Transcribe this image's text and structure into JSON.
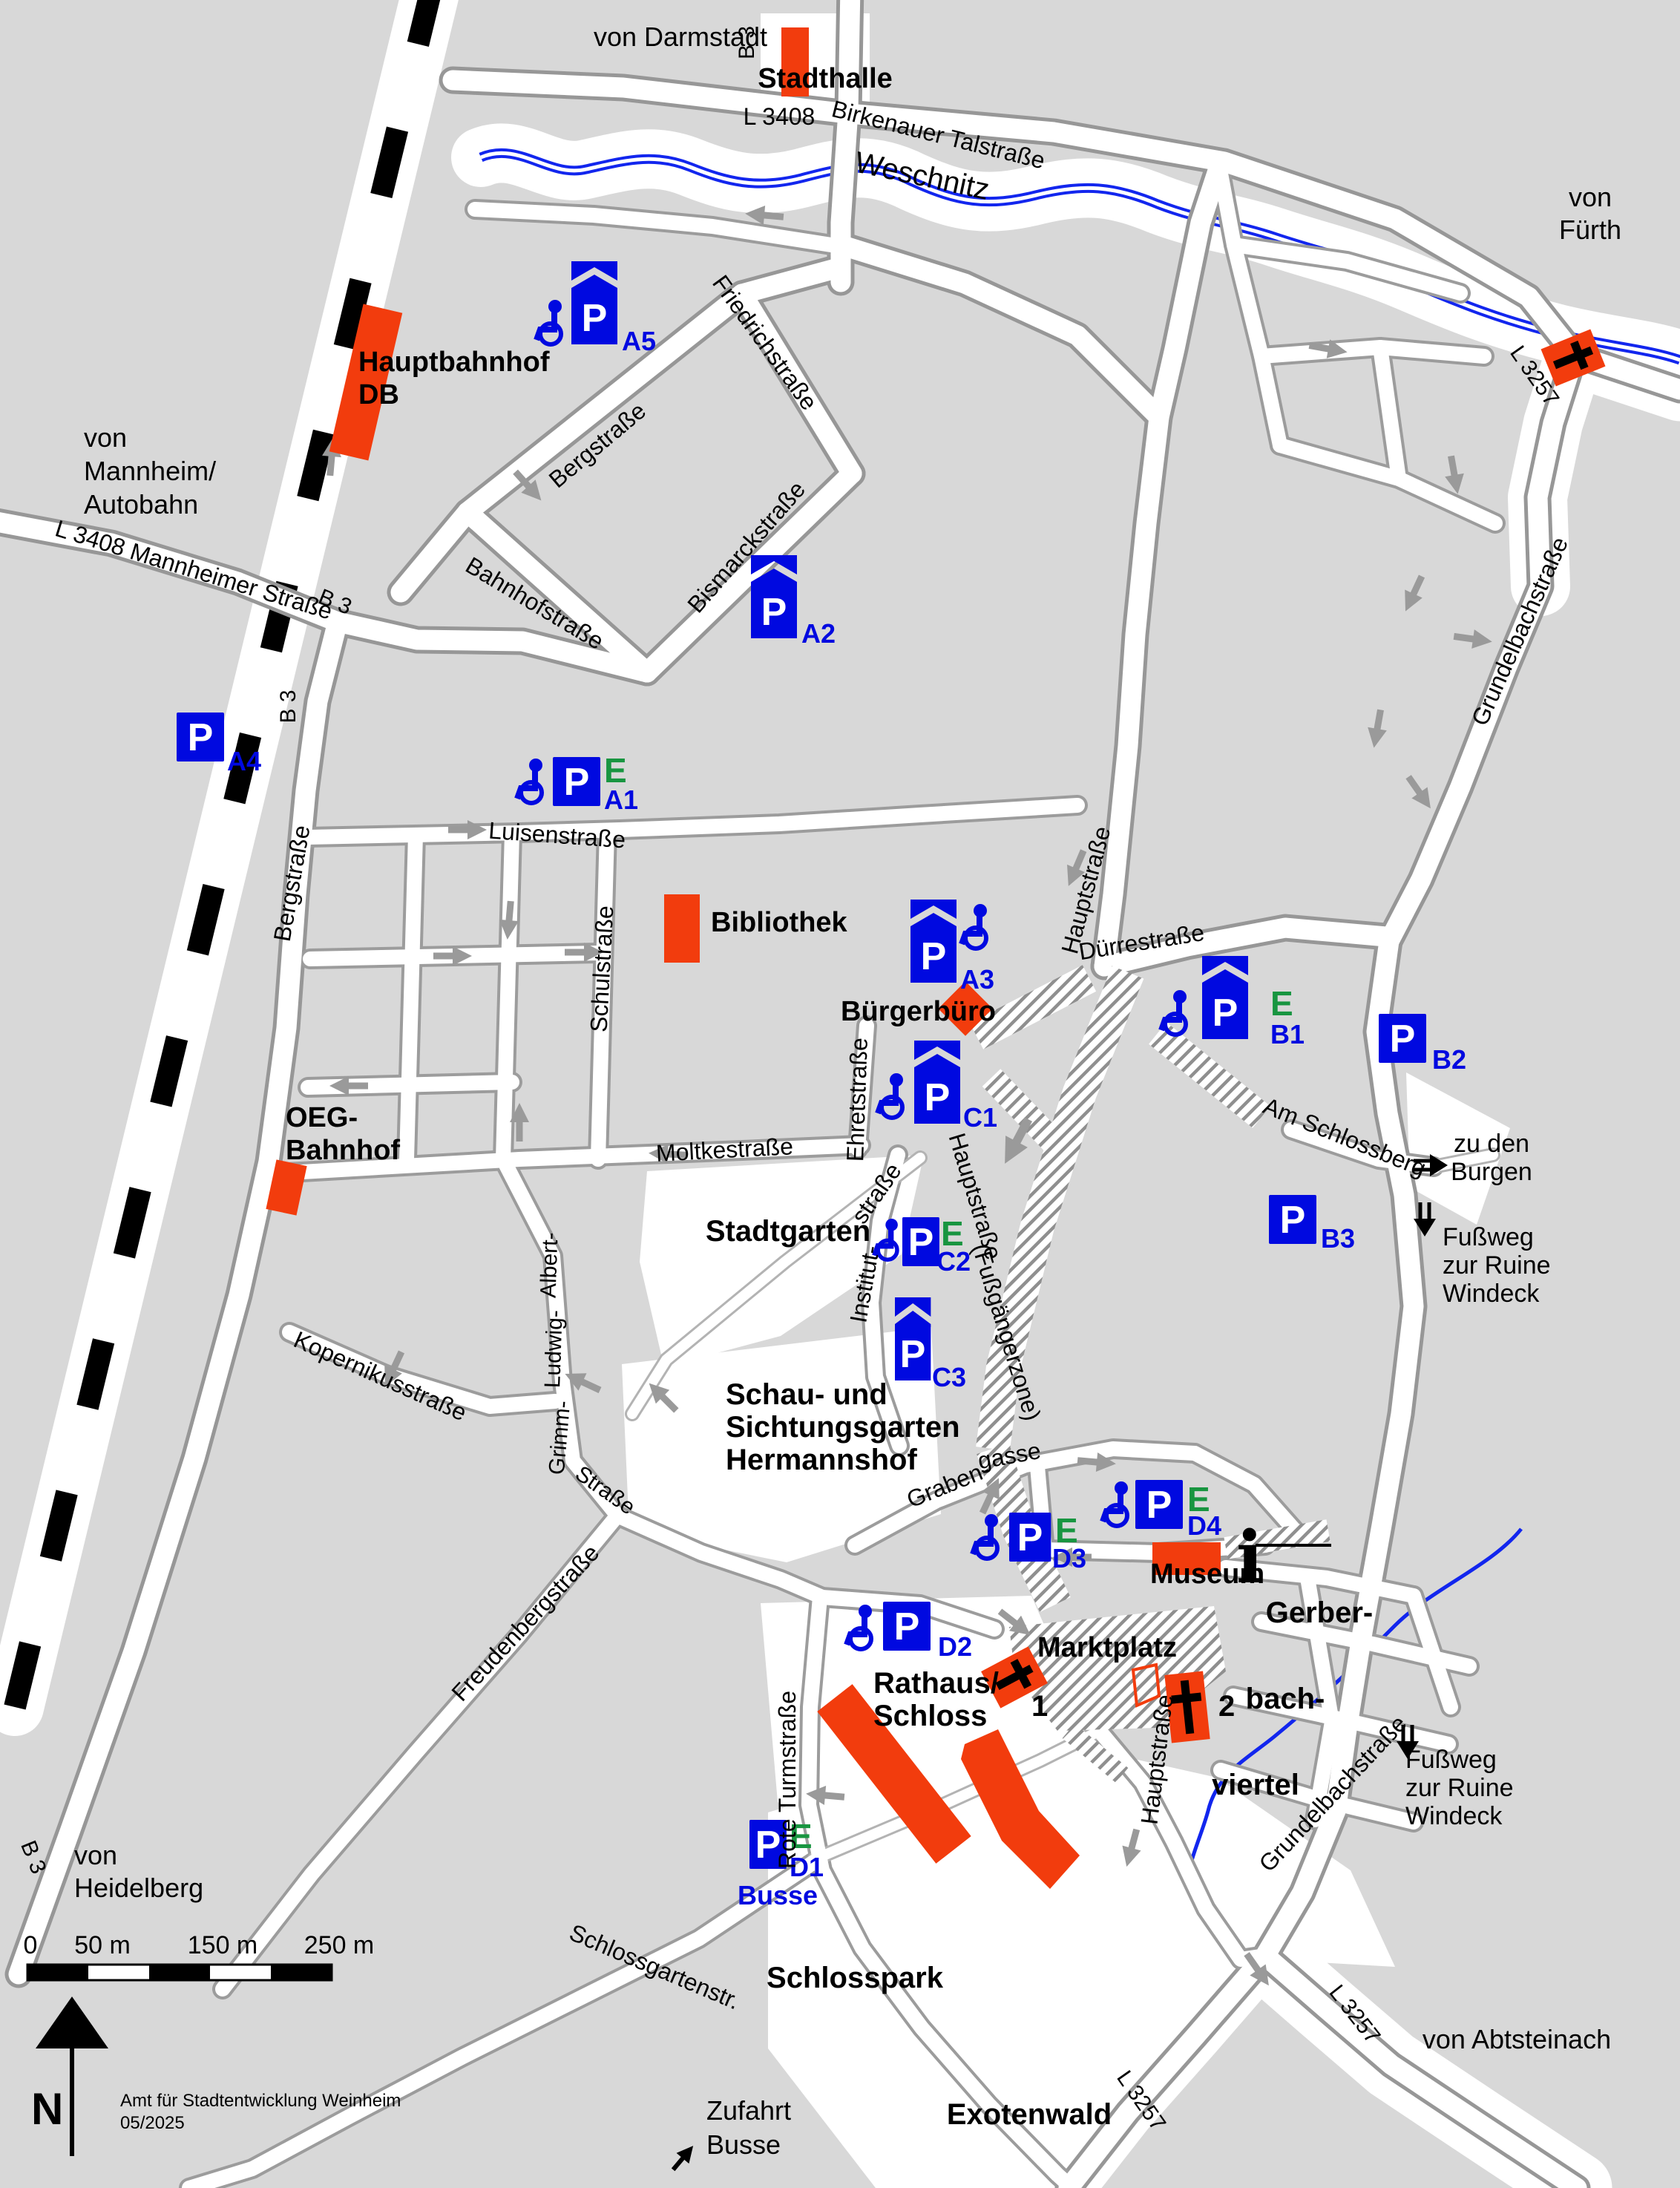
{
  "labels": {
    "von_darmstadt": "von Darmstadt",
    "b3_top": "B 3",
    "stadthalle": "Stadthalle",
    "l3408": "L 3408",
    "birkenauer_talstrasse": "Birkenauer Talstraße",
    "weschnitz": "Weschnitz",
    "von_fuerth_1": "von",
    "von_fuerth_2": "Fürth",
    "l3257_ne": "L 3257",
    "hauptbahnhof_1": "Hauptbahnhof",
    "hauptbahnhof_2": "DB",
    "bergstrasse_ne": "Bergstraße",
    "friedrichstrasse": "Friedrichstraße",
    "bismarckstrasse": "Bismarckstraße",
    "bahnhofstrasse": "Bahnhofstraße",
    "von_mannheim_1": "von",
    "von_mannheim_2": "Mannheim/",
    "von_mannheim_3": "Autobahn",
    "l3408_mannheimer": "L 3408 Mannheimer Straße",
    "b3_junction": "B 3",
    "b3_junction_s": "B 3",
    "luisenstrasse": "Luisenstraße",
    "bibliothek": "Bibliothek",
    "bergstrasse_w": "Bergstraße",
    "schulstrasse": "Schulstraße",
    "hauptstrasse_n": "Hauptstraße",
    "duerrestrasse": "Dürrestraße",
    "grundelbachstrasse_n": "Grundelbachstraße",
    "buergerbuero": "Bürgerbüro",
    "ehretstrasse": "Ehretstraße",
    "moltkestrasse": "Moltkestraße",
    "am_schlossberg": "Am Schlossberg",
    "zu_den_burgen_1": "zu den",
    "zu_den_burgen_2": "Burgen",
    "fussweg_ne_1": "Fußweg",
    "fussweg_ne_2": "zur Ruine",
    "fussweg_ne_3": "Windeck",
    "stadtgarten": "Stadtgarten",
    "institutstrasse_1": "straße",
    "institutstrasse_2": "Institut-",
    "hauptstrasse_fgz_1": "Hauptstraße",
    "hauptstrasse_fgz_2": "(Fußgängerzone)",
    "hermannshof_1": "Schau- und",
    "hermannshof_2": "Sichtungsgarten",
    "hermannshof_3": "Hermannshof",
    "oeg_1": "OEG-",
    "oeg_2": "Bahnhof",
    "kopernikusstrasse": "Kopernikusstraße",
    "albert": "Albert-",
    "ludwig": "Ludwig-",
    "grimm": "Grimm-",
    "grimm_strasse": "Straße",
    "graben": "Graben-",
    "gasse": "gasse",
    "museum": "Museum",
    "gerber": "Gerber-",
    "bach": "bach-",
    "viertel": "viertel",
    "marktplatz": "Marktplatz",
    "rathaus_1": "Rathaus/",
    "rathaus_2": "Schloss",
    "hauptstrasse_s": "Hauptstraße",
    "rote_turmstrasse": "Rote Turmstraße",
    "freudenbergstrasse": "Freudenbergstraße",
    "schlossgartenstr": "Schlossgartenstr.",
    "schlosspark": "Schlosspark",
    "zufahrt_1": "Zufahrt",
    "zufahrt_2": "Busse",
    "exotenwald": "Exotenwald",
    "l3257_se": "L 3257",
    "l3257_s": "L 3257",
    "von_abtsteinach": "von Abtsteinach",
    "von_heidelberg_1": "von",
    "von_heidelberg_2": "Heidelberg",
    "b3_sw": "B 3",
    "grundelbachstrasse_s": "Grundelbachstraße",
    "fussweg_se_1": "Fußweg",
    "fussweg_se_2": "zur Ruine",
    "fussweg_se_3": "Windeck"
  },
  "parking": {
    "p_letter": "P",
    "e_letter": "E",
    "lots": [
      {
        "id": "A1",
        "wheelchair": true,
        "covered": false,
        "charging": true
      },
      {
        "id": "A2",
        "wheelchair": false,
        "covered": true,
        "charging": false
      },
      {
        "id": "A3",
        "wheelchair": true,
        "covered": true,
        "charging": false
      },
      {
        "id": "A4",
        "wheelchair": false,
        "covered": false,
        "charging": false
      },
      {
        "id": "A5",
        "wheelchair": true,
        "covered": true,
        "charging": false
      },
      {
        "id": "B1",
        "wheelchair": true,
        "covered": true,
        "charging": true
      },
      {
        "id": "B2",
        "wheelchair": false,
        "covered": false,
        "charging": false
      },
      {
        "id": "B3",
        "wheelchair": false,
        "covered": false,
        "charging": false
      },
      {
        "id": "C1",
        "wheelchair": true,
        "covered": true,
        "charging": false
      },
      {
        "id": "C2",
        "wheelchair": true,
        "covered": false,
        "charging": true
      },
      {
        "id": "C3",
        "wheelchair": false,
        "covered": true,
        "charging": false
      },
      {
        "id": "D1",
        "wheelchair": false,
        "covered": false,
        "charging": true,
        "note": "Busse"
      },
      {
        "id": "D2",
        "wheelchair": true,
        "covered": false,
        "charging": false
      },
      {
        "id": "D3",
        "wheelchair": true,
        "covered": false,
        "charging": true
      },
      {
        "id": "D4",
        "wheelchair": true,
        "covered": false,
        "charging": true
      }
    ]
  },
  "churches": {
    "one": "1",
    "two": "2"
  },
  "info_icon_glyph": "i",
  "compass": {
    "north": "N"
  },
  "scale_bar": {
    "ticks": [
      "0",
      "50 m",
      "150 m",
      "250 m"
    ]
  },
  "credit": {
    "line1": "Amt für Stadtentwicklung Weinheim",
    "line2": "05/2025"
  },
  "colors": {
    "background_block": "#d8d8d8",
    "road_fill": "#ffffff",
    "road_casing": "#979797",
    "river_blue": "#1226ee",
    "parking_blue": "#0009e0",
    "charging_green": "#189540",
    "landmark_orange": "#f23c0d",
    "railway_black": "#000000",
    "arrow_gray": "#9a9a9a"
  }
}
